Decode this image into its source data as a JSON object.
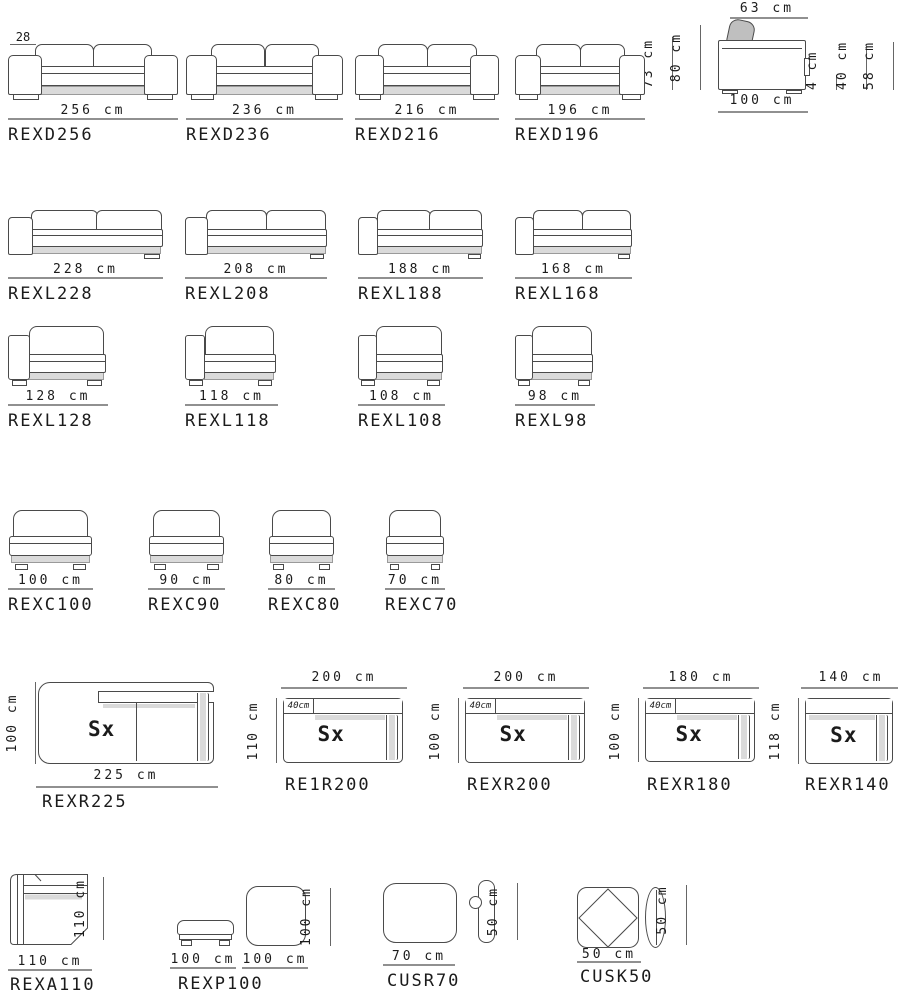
{
  "colors": {
    "line": "#4a4a4a",
    "shade": "#dadada",
    "dimline": "#909090",
    "text": "#1b1b1b"
  },
  "r1": {
    "items": [
      {
        "code": "REXD256",
        "dim": "256 cm",
        "note": "28"
      },
      {
        "code": "REXD236",
        "dim": "236 cm"
      },
      {
        "code": "REXD216",
        "dim": "216 cm"
      },
      {
        "code": "REXD196",
        "dim": "196 cm"
      }
    ],
    "side": {
      "top": "63 cm",
      "left_outer": "73 cm",
      "left_inner": "80 cm",
      "bottom": "100 cm",
      "right_1": "4 cm",
      "right_2": "40 cm",
      "right_3": "58 cm"
    }
  },
  "r2": {
    "items": [
      {
        "code": "REXL228",
        "dim": "228 cm"
      },
      {
        "code": "REXL208",
        "dim": "208 cm"
      },
      {
        "code": "REXL188",
        "dim": "188 cm"
      },
      {
        "code": "REXL168",
        "dim": "168 cm"
      }
    ]
  },
  "r3": {
    "items": [
      {
        "code": "REXL128",
        "dim": "128 cm"
      },
      {
        "code": "REXL118",
        "dim": "118 cm"
      },
      {
        "code": "REXL108",
        "dim": "108 cm"
      },
      {
        "code": "REXL98",
        "dim": "98 cm"
      }
    ]
  },
  "r4": {
    "items": [
      {
        "code": "REXC100",
        "dim": "100 cm"
      },
      {
        "code": "REXC90",
        "dim": "90 cm"
      },
      {
        "code": "REXC80",
        "dim": "80 cm"
      },
      {
        "code": "REXC70",
        "dim": "70 cm"
      }
    ]
  },
  "r5": {
    "items": [
      {
        "code": "REXR225",
        "width": "225 cm",
        "depth": "100 cm",
        "marker": "Sx"
      },
      {
        "code": "RE1R200",
        "width": "200 cm",
        "depth": "110 cm",
        "back_depth": "40cm",
        "marker": "Sx"
      },
      {
        "code": "REXR200",
        "width": "200 cm",
        "depth": "100 cm",
        "back_depth": "40cm",
        "marker": "Sx"
      },
      {
        "code": "REXR180",
        "width": "180 cm",
        "depth": "100 cm",
        "back_depth": "40cm",
        "marker": "Sx"
      },
      {
        "code": "REXR140",
        "width": "140 cm",
        "depth": "118 cm",
        "marker": "Sx"
      }
    ]
  },
  "r6": {
    "items": [
      {
        "code": "REXA110",
        "width": "110 cm",
        "depth": "110 cm"
      },
      {
        "code": "REXP100",
        "side_width": "100 cm",
        "top_width": "100 cm",
        "top_depth": "100 cm"
      },
      {
        "code": "CUSR70",
        "width": "70 cm",
        "height": "50 cm"
      },
      {
        "code": "CUSK50",
        "width": "50 cm",
        "height": "50 cm"
      }
    ]
  }
}
